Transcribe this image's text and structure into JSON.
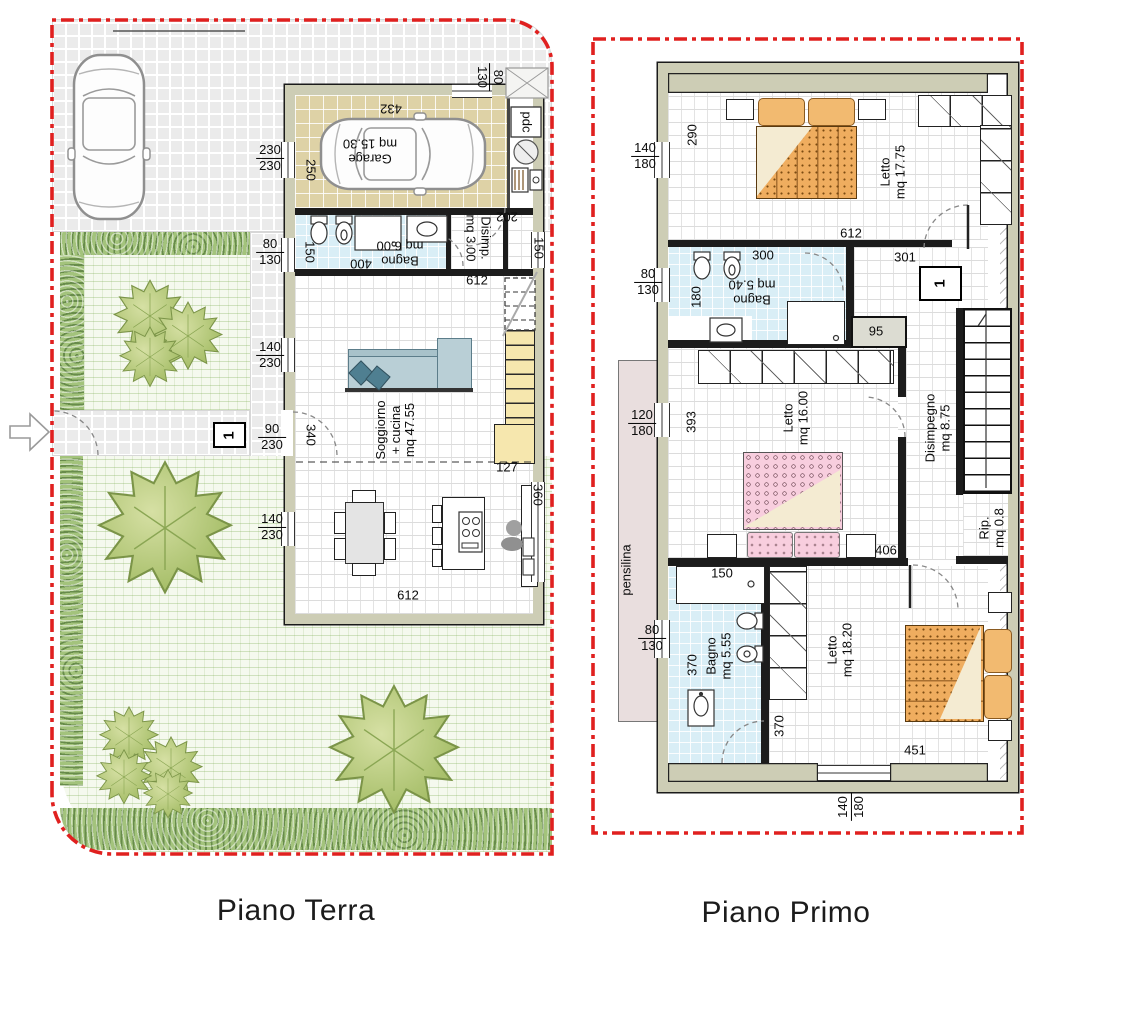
{
  "titles": {
    "ground": "Piano Terra",
    "first": "Piano Primo"
  },
  "colors": {
    "boundary_red": "#e0201f",
    "wall_fill": "#cdcdb5",
    "garage_floor": "#ded2a6",
    "bath_floor": "#d9eef6",
    "stair_fill": "#f6e7ae",
    "lawn": "#f5f9ee",
    "hedge": "#a3c37c",
    "pensilina_fill": "#e9dede",
    "bed_orange": "#efad5f",
    "bed_pink": "#f8cede"
  },
  "ground_floor": {
    "rooms": {
      "garage": {
        "name": "Garage",
        "area": "mq 15.30"
      },
      "bagno": {
        "name": "Bagno",
        "area": "mq 6.00"
      },
      "disimpegno": {
        "name": "Disimp.",
        "area": "mq 3.00"
      },
      "soggiorno": {
        "name": "Soggiorno",
        "name2": "+ cucina",
        "area": "mq 47.55"
      }
    },
    "labels": {
      "pdc": "pdc",
      "door_number": "1"
    },
    "dims": {
      "top_80_130": {
        "a": "80",
        "b": "130"
      },
      "garage_width": "432",
      "drive_230_230": {
        "a": "230",
        "b": "230"
      },
      "garage_depth": "250",
      "disimp_width": "202",
      "east_150": "150",
      "west_80_130": {
        "a": "80",
        "b": "130"
      },
      "bagno_depth": "150",
      "bagno_width": "400",
      "width_612_top": "612",
      "win_140_230": {
        "a": "140",
        "b": "230"
      },
      "door_90_230": {
        "a": "90",
        "b": "230"
      },
      "door_340": "340",
      "stair_127": "127",
      "win2_140_230": {
        "a": "140",
        "b": "230"
      },
      "east_360": "360",
      "width_612_bottom": "612"
    }
  },
  "first_floor": {
    "rooms": {
      "letto1": {
        "name": "Letto",
        "area": "mq 17.75"
      },
      "bagno1": {
        "name": "Bagno",
        "area": "mq 5.40"
      },
      "letto2": {
        "name": "Letto",
        "area": "mq 16.00"
      },
      "disimpegno": {
        "name": "Disimpegno",
        "area": "mq 8.75"
      },
      "rip": {
        "name": "Rip.",
        "area": "mq 0.8"
      },
      "bagno2": {
        "name": "Bagno",
        "area": "mq 5.55"
      },
      "letto3": {
        "name": "Letto",
        "area": "mq 18.20"
      }
    },
    "labels": {
      "pensilina": "pensilina",
      "door_number": "1"
    },
    "dims": {
      "win_140_180": {
        "a": "140",
        "b": "180"
      },
      "room1_depth": "290",
      "width_612": "612",
      "hall_301": "301",
      "west_80_130": {
        "a": "80",
        "b": "130"
      },
      "bagno_depth": "180",
      "bagno_width": "300",
      "niche_95": "95",
      "win_120_180": {
        "a": "120",
        "b": "180"
      },
      "room2_depth": "393",
      "hall_406": "406",
      "shower_150": "150",
      "west2_80_130": {
        "a": "80",
        "b": "130"
      },
      "bagno2_depth": "370",
      "ward_370": "370",
      "room3_width": "451",
      "win_bottom_140_180": {
        "a": "140",
        "b": "180"
      }
    }
  }
}
